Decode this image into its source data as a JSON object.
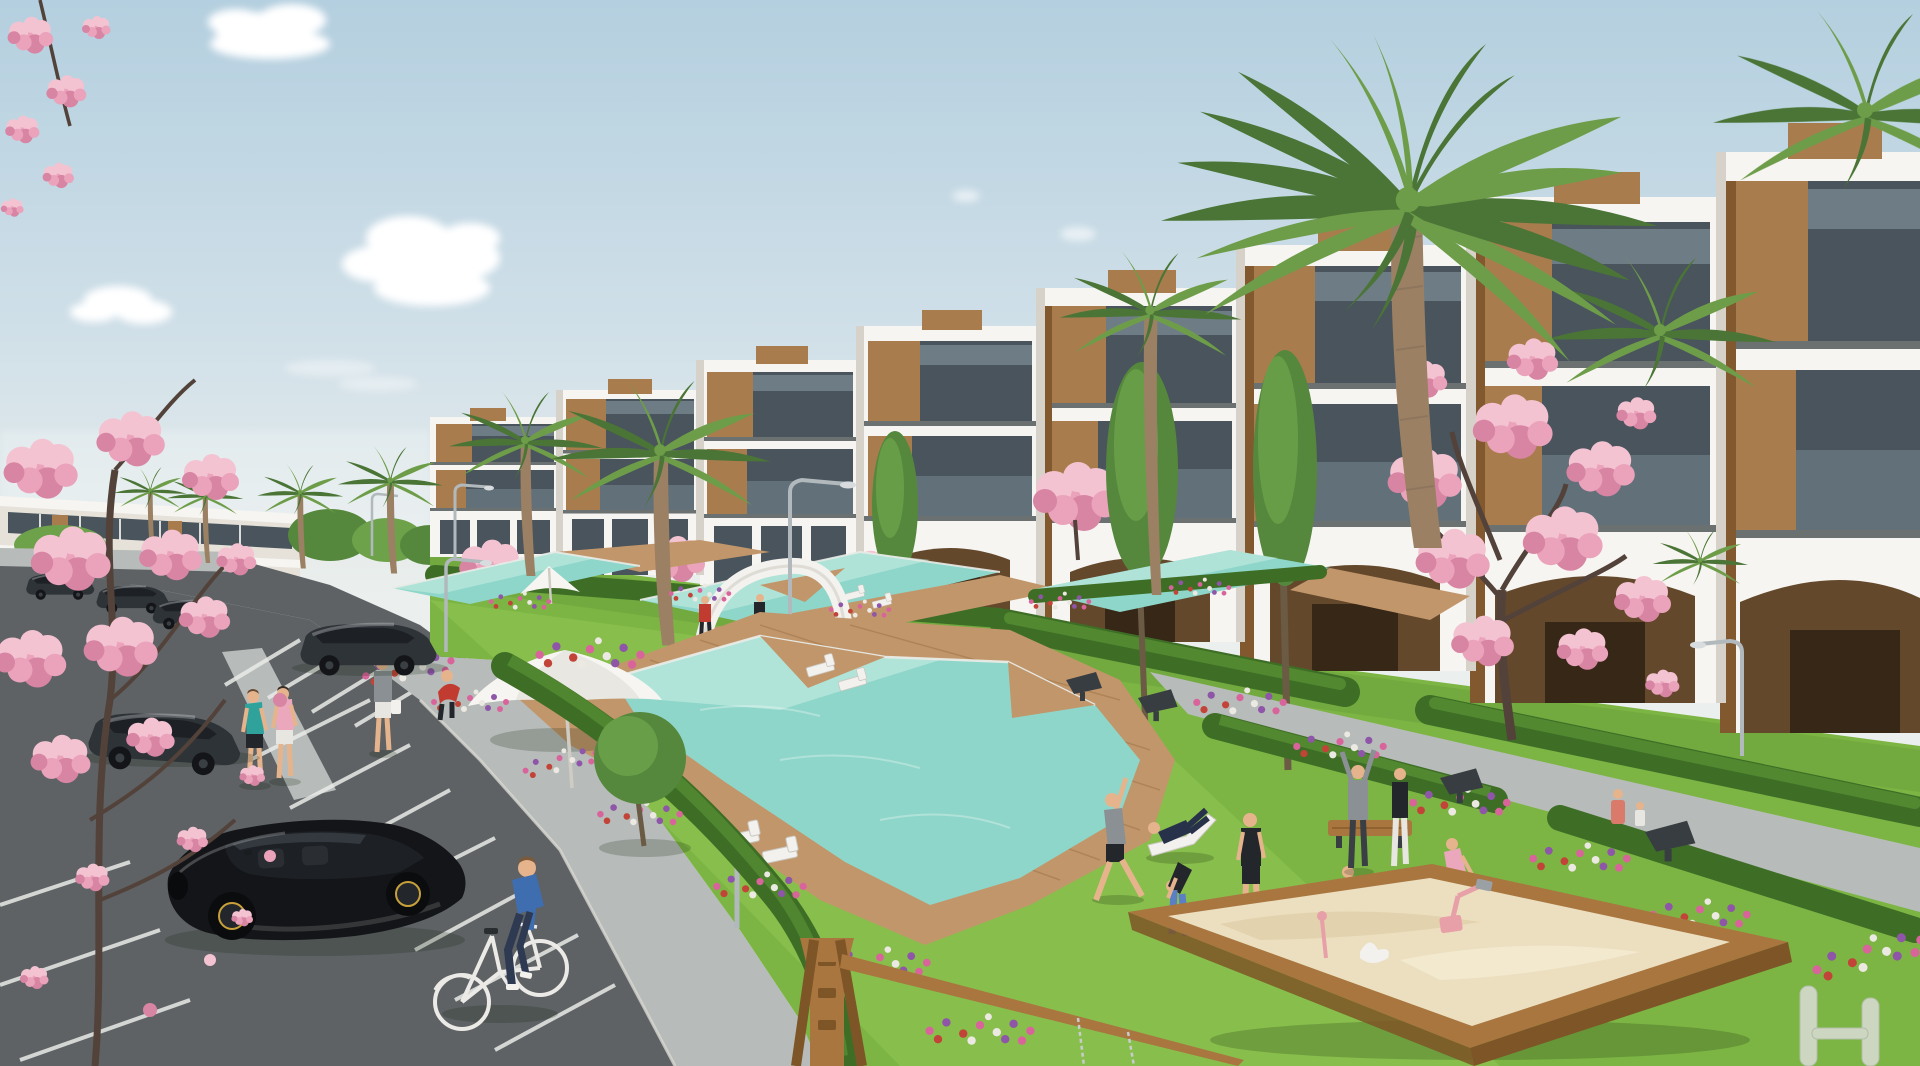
{
  "scene": {
    "type": "architectural-render",
    "description": "Sunny 3D visualization of a modern white terraced apartment complex with wood accents, cascading turquoise pools, lawns with flower beds, a parking lot with cars, a cyclist, people exercising on the grass, a sandbox playground and palm and pink blossom trees under a pale blue sky.",
    "elements": [
      {
        "name": "sky",
        "label": "pale blue sky with soft clouds"
      },
      {
        "name": "main-building",
        "label": "white terraced apartment block with wood panels and glass balconies"
      },
      {
        "name": "left-building",
        "label": "distant two-storey white building"
      },
      {
        "name": "arcade-arches",
        "label": "ground floor arched colonnade"
      },
      {
        "name": "upper-pools",
        "label": "three cascading lap pools with wooden decks"
      },
      {
        "name": "main-pool",
        "label": "large turquoise pool with deck wedges"
      },
      {
        "name": "gate-arch",
        "label": "white curved gateway arch"
      },
      {
        "name": "sun-umbrella",
        "label": "white parasols"
      },
      {
        "name": "parking-lot",
        "label": "asphalt parking with white bay markings"
      },
      {
        "name": "black-hatchback",
        "label": "black hatchback car in foreground"
      },
      {
        "name": "cyclist",
        "label": "man in blue riding a bicycle"
      },
      {
        "name": "pedestrians",
        "label": "people walking and exercising"
      },
      {
        "name": "sandbox",
        "label": "wooden sandbox with pink play toys"
      },
      {
        "name": "swing-frame",
        "label": "wooden playground frame"
      },
      {
        "name": "palm-trees",
        "label": "palm trees"
      },
      {
        "name": "blossom-trees",
        "label": "pink cherry blossom trees"
      },
      {
        "name": "hedges-flowers",
        "label": "hedge rows and colorful flower beds"
      },
      {
        "name": "street-lamps",
        "label": "curved gray street lamps"
      },
      {
        "name": "benches",
        "label": "dark wedge benches and wooden bench"
      },
      {
        "name": "sun-loungers",
        "label": "white sun loungers"
      }
    ]
  },
  "palette": {
    "sky_top": "#b4cfdf",
    "sky_mid": "#cfdfe8",
    "sky_horizon": "#ebefed",
    "cloud": "#ffffff",
    "white": "#f6f5f1",
    "white_shade": "#e6e2da",
    "white_dark": "#d7d2c9",
    "trim": "#31373b",
    "glass": "#49545c",
    "glass_hl": "#93a5ae",
    "wood": "#a97c4e",
    "wood_dark": "#82592f",
    "arch_interior": "#64482c",
    "arch_door": "#362717",
    "grass": "#7cb544",
    "grass_light": "#96ca57",
    "grass_dark": "#5d9136",
    "hedge": "#3e6e26",
    "hedge_light": "#578f33",
    "tree": "#55883c",
    "tree_light": "#6da24b",
    "tree_trunk": "#6b5a44",
    "palm": "#4a7536",
    "palm_light": "#6e9d49",
    "palm_trunk": "#9b8063",
    "pool": "#8ed6c9",
    "pool_light": "#c4ebe2",
    "deck": "#c2966b",
    "deck_dark": "#96703f",
    "asphalt": "#5e6265",
    "pavement": "#b7bcba",
    "line": "#e9ebe7",
    "blossom_light": "#f4c3d2",
    "blossom": "#eaa3bb",
    "blossom_deep": "#d884a3",
    "branch": "#52423a",
    "sand": "#ecdfc0",
    "sandbox_wood": "#a9763f",
    "sandbox_wood_dark": "#7e5526",
    "car_black": "#141518",
    "car_dark": "#2e3338",
    "car_glass": "#1d2126",
    "skin": "#e6b48c",
    "lamp": "#b2b9bd",
    "furniture_white": "#f2f1ed",
    "furniture_gray": "#c9c7c0",
    "bench_dark": "#383d41",
    "flower_pink": "#d9649b",
    "flower_purple": "#8e55a8",
    "flower_red": "#c24438",
    "flower_white": "#ece8e2",
    "teal_top": "#2fa29b",
    "pink_top": "#eba8bc",
    "blue_sweater": "#3e6db0",
    "jeans": "#2e3a52",
    "red_shirt": "#c13b31",
    "navy": "#27324a",
    "gray_cloth": "#8a9094",
    "legging_blue": "#5b7fc4",
    "white_cloth": "#e8e6e0",
    "coral": "#d97a6a",
    "black_cloth": "#23262a",
    "wheel_accent": "#c9a13b"
  }
}
